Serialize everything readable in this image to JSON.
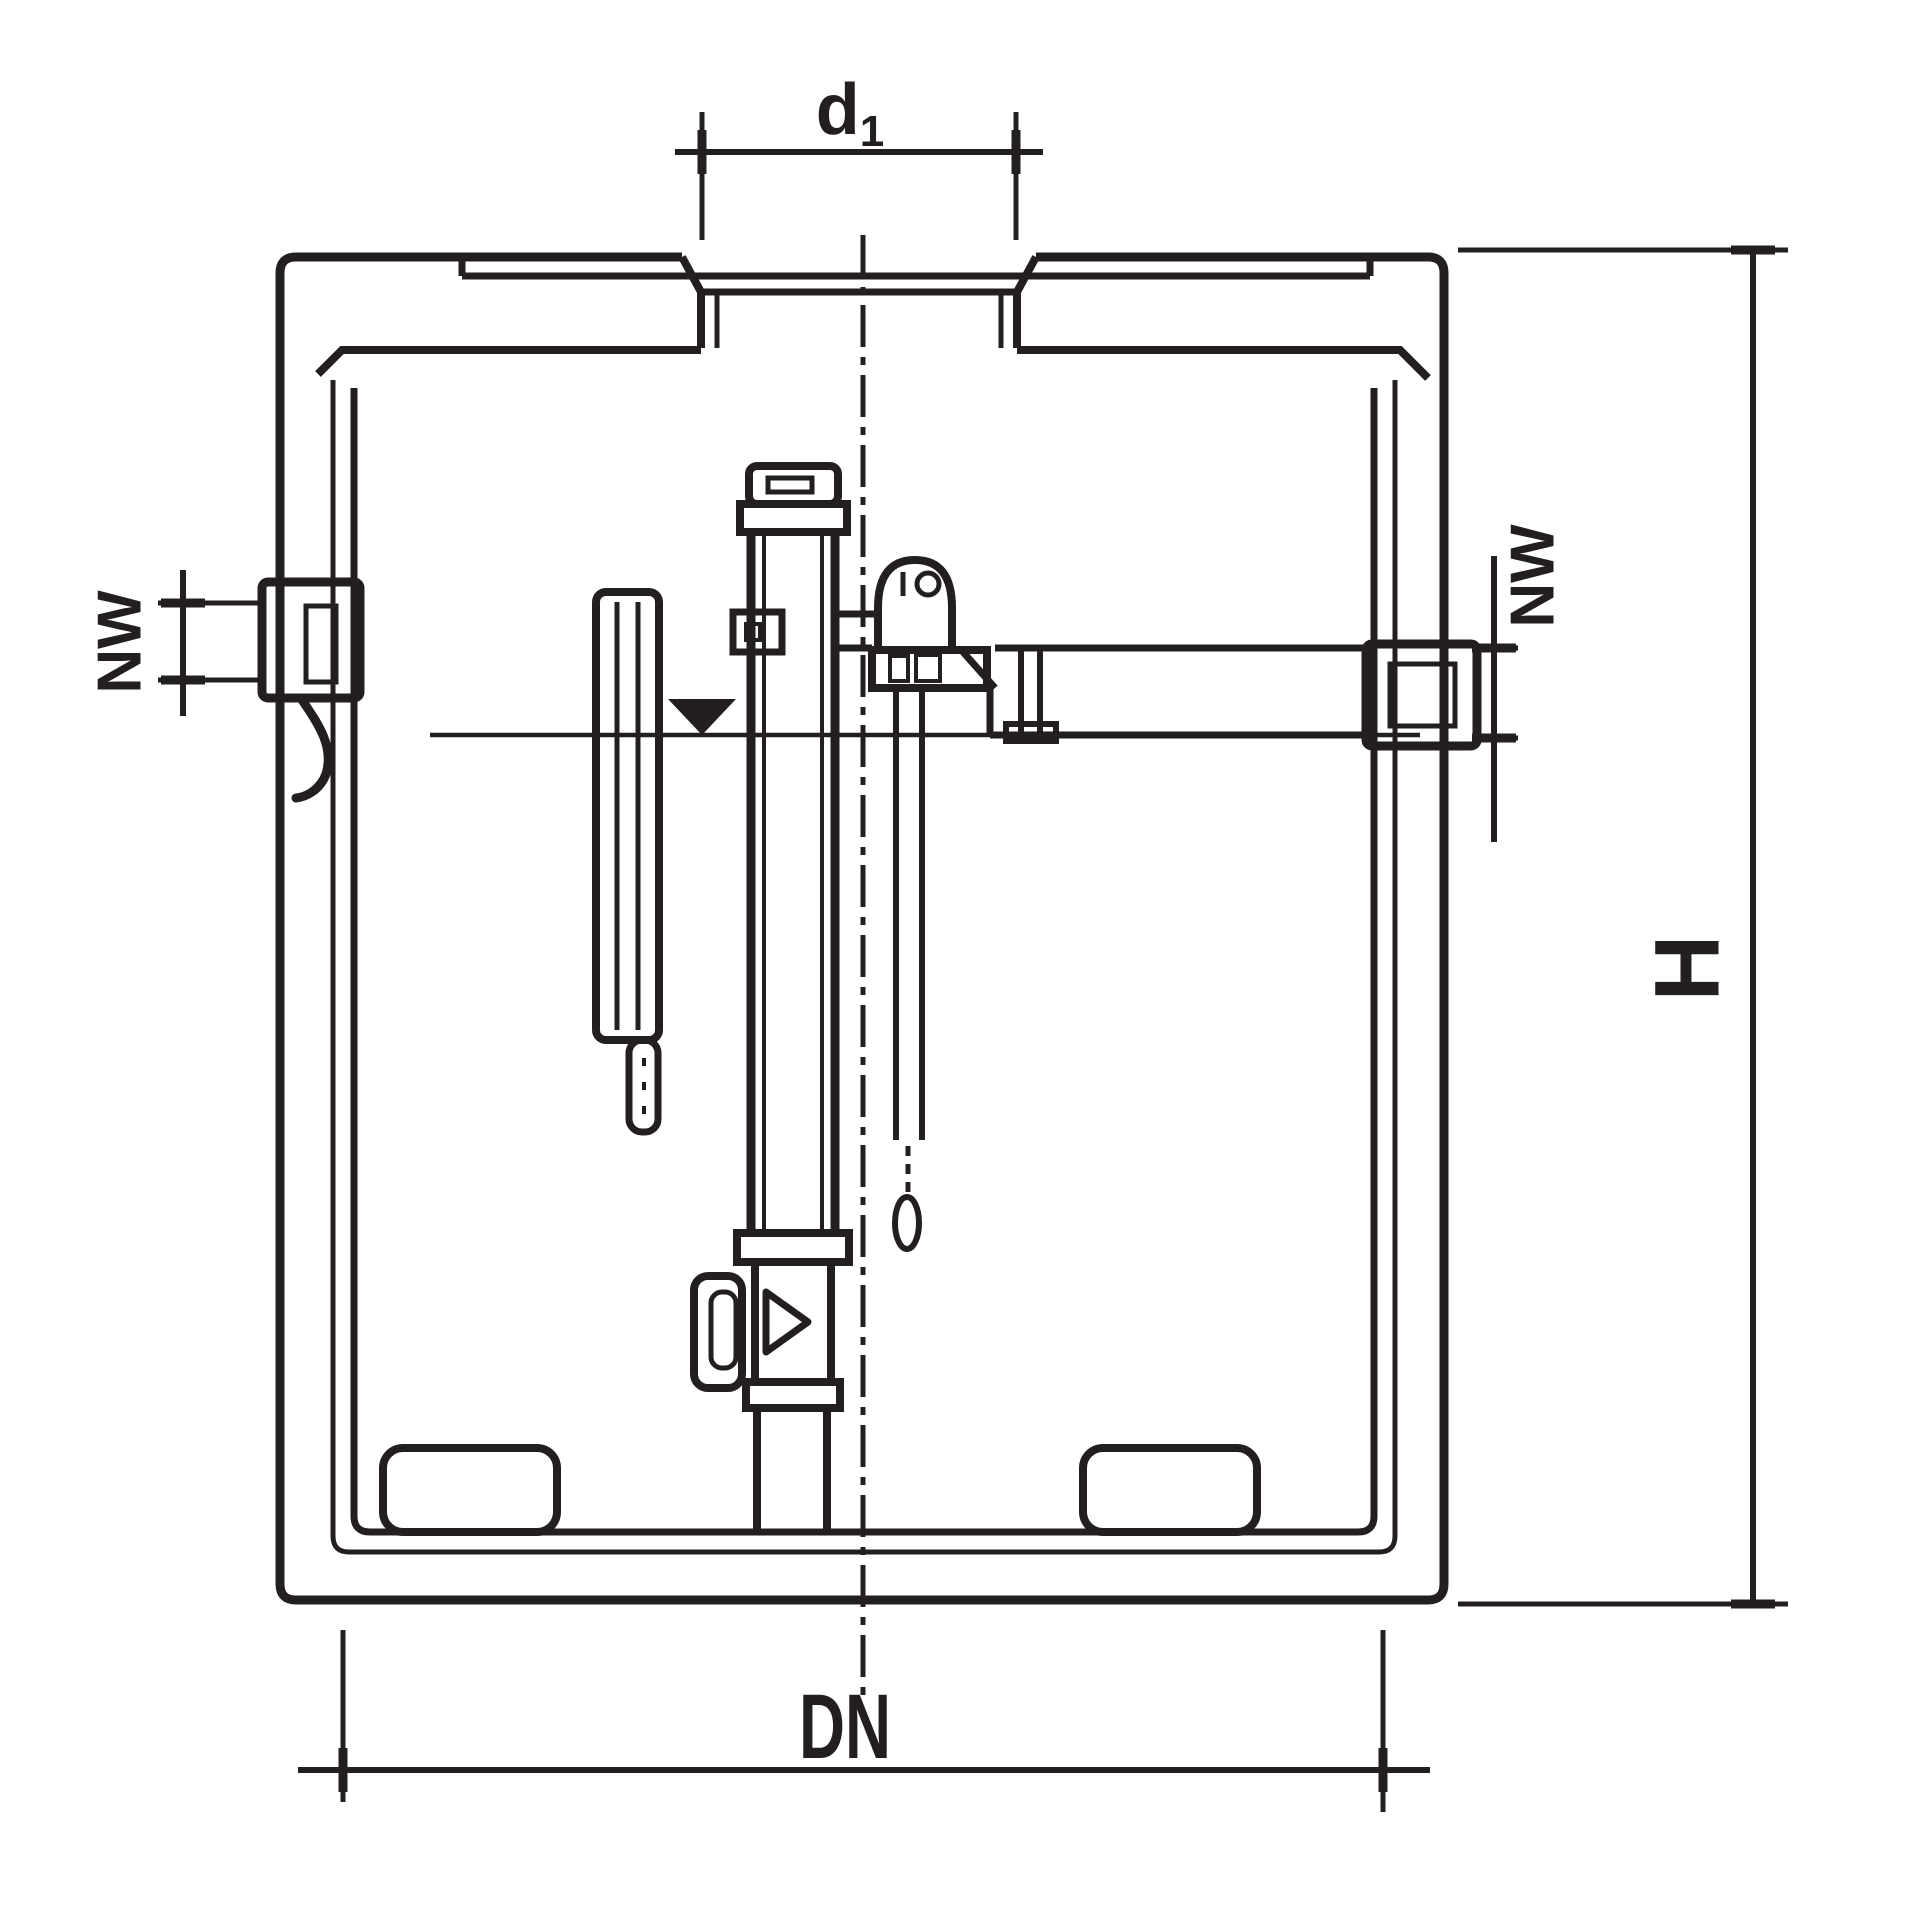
{
  "drawing": {
    "line_color": "#231f20",
    "background_color": "#ffffff",
    "dimensions": {
      "inlet_diameter": {
        "base": "d",
        "sub": "1"
      },
      "inlet_left": {
        "label": "NW"
      },
      "outlet_right": {
        "label": "NW"
      },
      "height": {
        "label": "H"
      },
      "width": {
        "label": "DN"
      }
    }
  }
}
